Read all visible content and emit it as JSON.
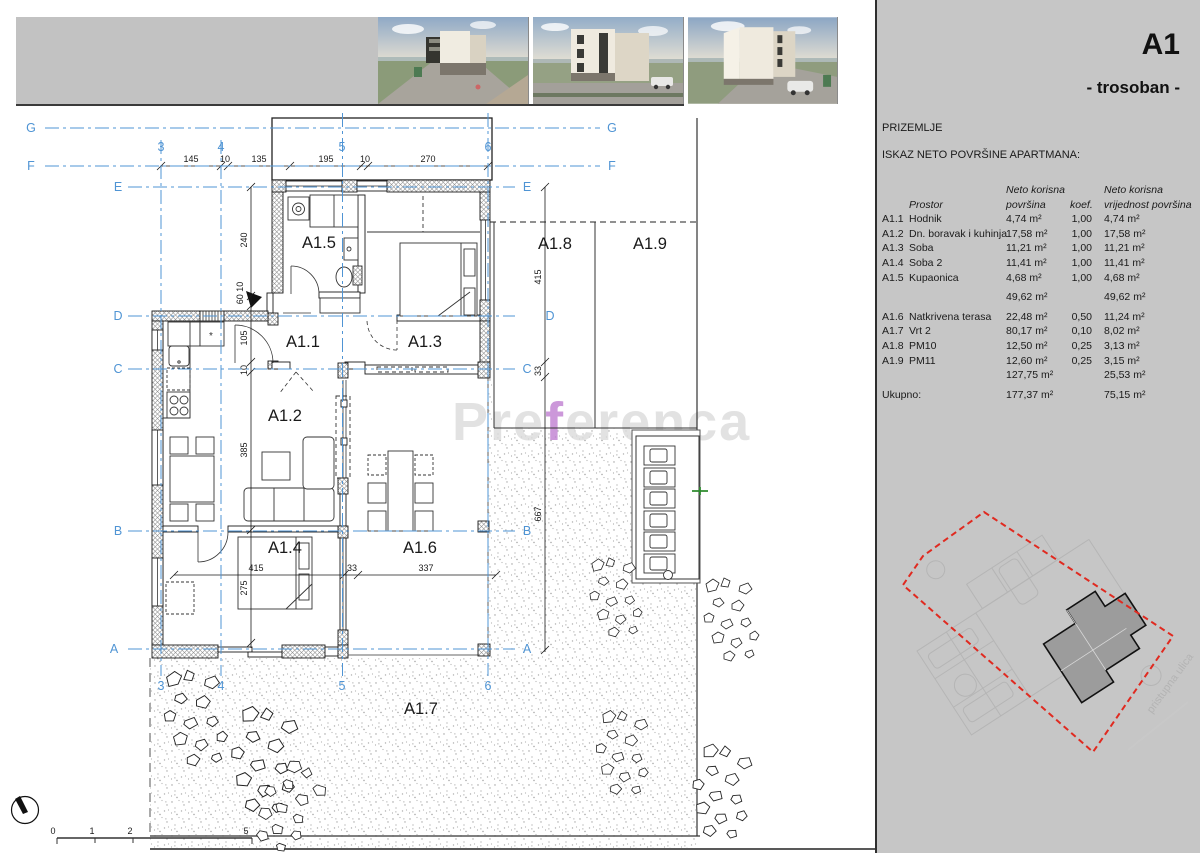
{
  "panel": {
    "unit_title": "A1",
    "unit_subtitle": "- trosoban -",
    "floor_label": "PRIZEMLJE",
    "table_title": "ISKAZ NETO POVRŠINE APARTMANA:",
    "table": {
      "header": {
        "prostor": "Prostor",
        "area_line1": "Neto korisna",
        "area_line2": "površina",
        "koef": "koef.",
        "value_line1": "Neto korisna",
        "value_line2": "vrijednost površina"
      },
      "rows": [
        {
          "code": "A1.1",
          "name": "Hodnik",
          "area": "4,74 m²",
          "koef": "1,00",
          "value": "4,74 m²"
        },
        {
          "code": "A1.2",
          "name": "Dn. boravak i kuhinja",
          "area": "17,58 m²",
          "koef": "1,00",
          "value": "17,58 m²"
        },
        {
          "code": "A1.3",
          "name": "Soba",
          "area": "11,21 m²",
          "koef": "1,00",
          "value": "11,21 m²"
        },
        {
          "code": "A1.4",
          "name": "Soba 2",
          "area": "11,41 m²",
          "koef": "1,00",
          "value": "11,41 m²"
        },
        {
          "code": "A1.5",
          "name": "Kupaonica",
          "area": "4,68 m²",
          "koef": "1,00",
          "value": "4,68 m²"
        },
        {
          "code": "",
          "name": "",
          "area": "49,62 m²",
          "koef": "",
          "value": "49,62 m²",
          "gap": true
        },
        {
          "code": "A1.6",
          "name": "Natkrivena terasa",
          "area": "22,48 m²",
          "koef": "0,50",
          "value": "11,24 m²",
          "gap": true
        },
        {
          "code": "A1.7",
          "name": "Vrt 2",
          "area": "80,17 m²",
          "koef": "0,10",
          "value": "8,02 m²"
        },
        {
          "code": "A1.8",
          "name": "PM10",
          "area": "12,50 m²",
          "koef": "0,25",
          "value": "3,13 m²"
        },
        {
          "code": "A1.9",
          "name": "PM11",
          "area": "12,60 m²",
          "koef": "0,25",
          "value": "3,15 m²"
        },
        {
          "code": "",
          "name": "",
          "area": "127,75 m²",
          "koef": "",
          "value": "25,53 m²"
        },
        {
          "code": "Ukupno:",
          "name": "",
          "area": "177,37 m²",
          "koef": "",
          "value": "75,15 m²",
          "gap": true
        }
      ]
    },
    "site_plan": {
      "street_label": "pristupna ulica",
      "boundary_color": "#e02a20"
    }
  },
  "plan": {
    "rooms": [
      "A1.1",
      "A1.2",
      "A1.3",
      "A1.4",
      "A1.5",
      "A1.6",
      "A1.7",
      "A1.8",
      "A1.9"
    ],
    "grid": {
      "horizontal": [
        "G",
        "F",
        "E",
        "D",
        "C",
        "B",
        "A"
      ],
      "vertical": [
        "3",
        "4",
        "5",
        "6"
      ]
    },
    "dimensions": {
      "top": [
        "145",
        "10",
        "135",
        "195",
        "10",
        "270"
      ],
      "left": [
        "240",
        "60 10",
        "105",
        "10",
        "385",
        "275"
      ],
      "right": [
        "415",
        "33",
        "667"
      ],
      "bottom": [
        "415",
        "33",
        "337"
      ]
    },
    "scale_bar": [
      "0",
      "1",
      "2",
      "5"
    ],
    "watermark": {
      "pre": "Pre",
      "accent": "f",
      "rest": "erenca",
      "accent_color": "#c07fd2"
    }
  }
}
